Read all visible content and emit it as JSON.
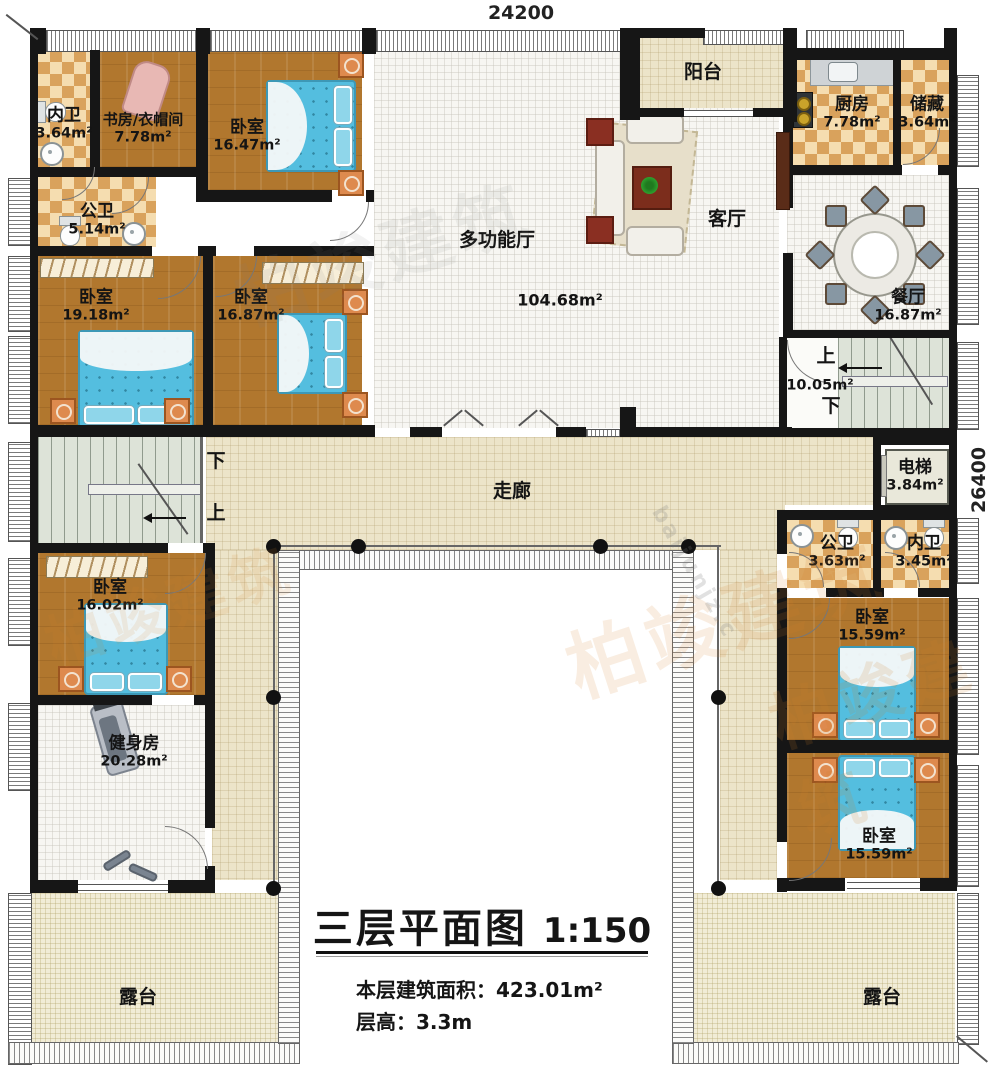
{
  "meta": {
    "title": "三层平面图",
    "scale": "1:150",
    "area_label": "本层建筑面积：",
    "area_value": "423.01m²",
    "floor_height_label": "层高：",
    "floor_height_value": "3.3m"
  },
  "dims": {
    "top": "24200",
    "right": "26400"
  },
  "rooms": [
    {
      "name": "内卫",
      "area": "3.64m²"
    },
    {
      "name": "书房/衣帽间",
      "area": "7.78m²"
    },
    {
      "name": "卧室",
      "area": "16.47m²"
    },
    {
      "name": "公卫",
      "area": "5.14m²"
    },
    {
      "name": "卧室",
      "area": "19.18m²"
    },
    {
      "name": "卧室",
      "area": "16.87m²"
    },
    {
      "name": "阳台",
      "area": ""
    },
    {
      "name": "多功能厅",
      "area": "104.68m²"
    },
    {
      "name": "客厅",
      "area": ""
    },
    {
      "name": "厨房",
      "area": "7.78m²"
    },
    {
      "name": "储藏",
      "area": "3.64m²"
    },
    {
      "name": "餐厅",
      "area": "16.87m²"
    },
    {
      "name": "电梯",
      "area": "3.84m²"
    },
    {
      "name": "走廊",
      "area": ""
    },
    {
      "name": "公卫",
      "area": "3.63m²"
    },
    {
      "name": "内卫",
      "area": "3.45m²"
    },
    {
      "name": "卧室",
      "area": "15.59m²"
    },
    {
      "name": "卧室",
      "area": "15.59m²"
    },
    {
      "name": "卧室",
      "area": "16.02m²"
    },
    {
      "name": "健身房",
      "area": "20.28m²"
    },
    {
      "name": "露台",
      "area": ""
    },
    {
      "name": "露台",
      "area": ""
    }
  ],
  "stairs": {
    "right": {
      "up": "上",
      "area": "10.05m²",
      "down": "下"
    },
    "left": {
      "down": "下",
      "up": "上"
    }
  },
  "watermark": {
    "brand_cn": "柏竣建筑",
    "brand_url": "baijunjz.c"
  }
}
